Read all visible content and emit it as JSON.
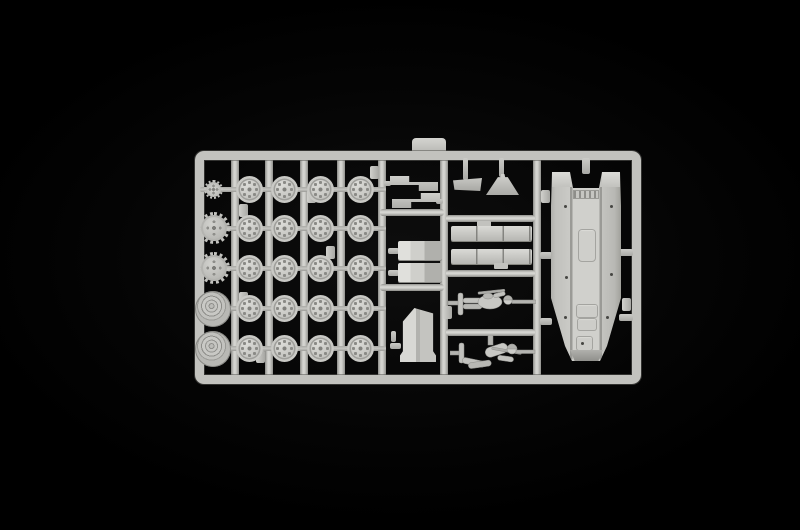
{
  "scene": {
    "description": "Overhead photograph of a light grey injection-moulded model kit sprue with unassembled parts on a black backdrop",
    "background_color": "#050505",
    "plastic_color": "#c6c6c2",
    "plastic_highlight": "#e0e0dc",
    "plastic_shadow": "#8f8f8b"
  },
  "sprue": {
    "road_wheels": {
      "rows": 5,
      "cols": 4,
      "count": 20
    },
    "left_column": {
      "idler_wheels": 1,
      "drive_sprockets": 2,
      "ringed_wheels": 2
    },
    "middle_column": {
      "stepped_brackets": 2,
      "box_parts": 2,
      "angled_plate": 1
    },
    "inner_column": {
      "small_flaps": 2,
      "segmented_bars": 2,
      "soldier_figures": 2
    },
    "right_column": {
      "vehicle_hulls": 1
    }
  }
}
